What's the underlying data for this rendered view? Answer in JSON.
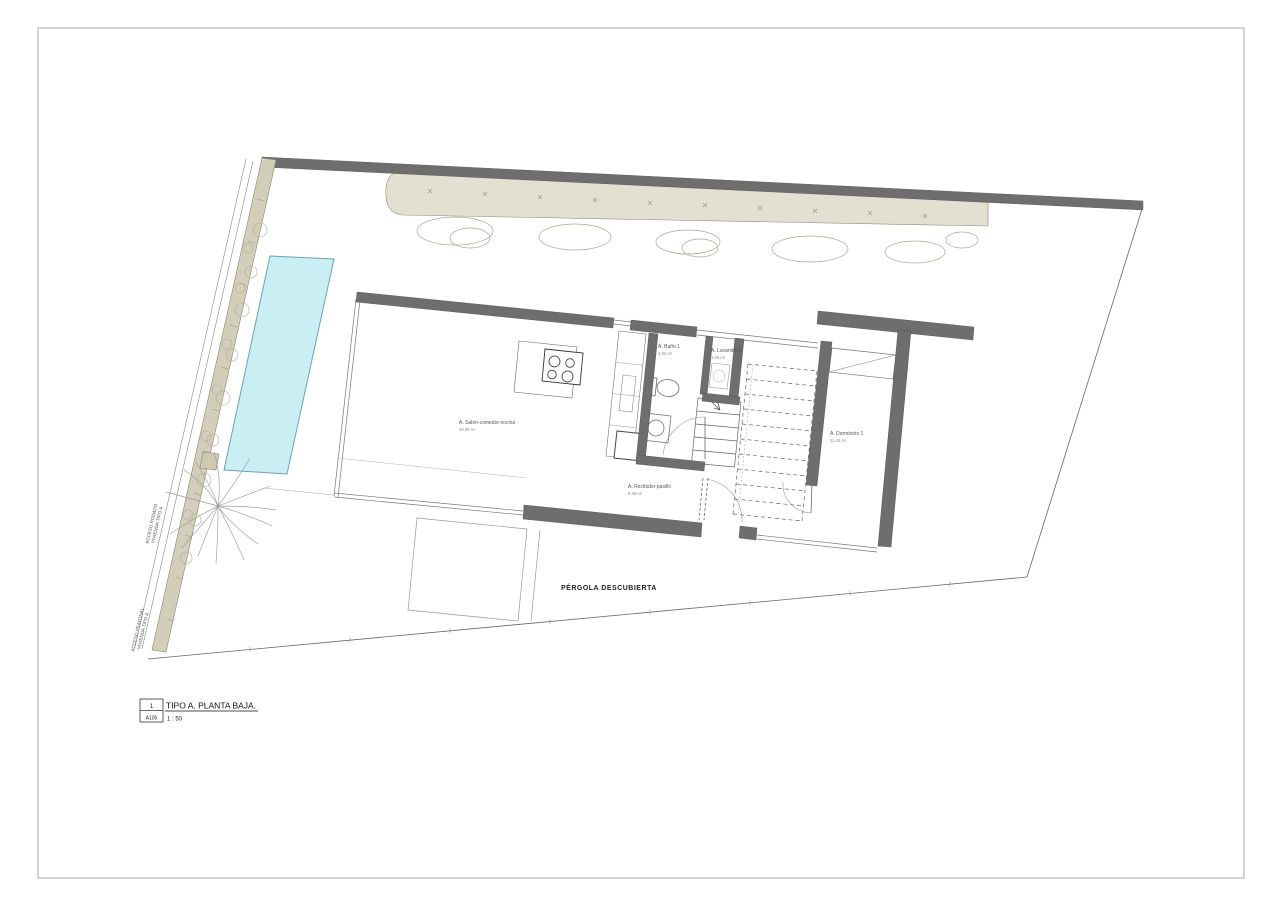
{
  "title_block": {
    "detail_number": "1",
    "sheet_code": "A105",
    "title": "TIPO A. PLANTA BAJA.",
    "scale": "1 : 50"
  },
  "plan": {
    "labels": {
      "pergola": "PÉRGOLA DESCUBIERTA",
      "acceso_rodado_line1": "ACCESO RODADO",
      "acceso_rodado_line2": "VIVIENDA TIPO A",
      "acceso_peatonal_line1": "ACCESO PEATONAL",
      "acceso_peatonal_line2": "VIVIENDA TIPO A"
    },
    "rooms": [
      {
        "name": "A. Salón-comedor-cocina",
        "area": "28.09 m²"
      },
      {
        "name": "A. Baño 1",
        "area": "4.03 m²"
      },
      {
        "name": "A. Lavandería",
        "area": "1.06 m²"
      },
      {
        "name": "A. Dormitorio 1",
        "area": "11.40 m²"
      },
      {
        "name": "A. Recibidor-pasillo",
        "area": "8.55 m²"
      }
    ],
    "colors": {
      "wall": "#6e6e6e",
      "planting_band": "#e3e0d2",
      "side_strip": "#d3ceba",
      "pool_fill": "#c9eef3",
      "pool_border": "#6fa3ad",
      "planter": "#cfc8b2"
    }
  }
}
